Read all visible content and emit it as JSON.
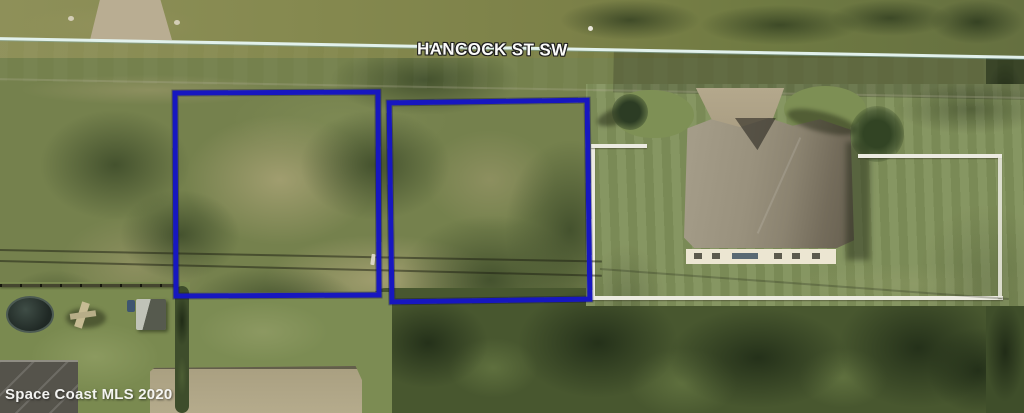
{
  "labels": {
    "street_name": "HANCOCK ST SW",
    "watermark": "Space Coast MLS 2020"
  },
  "colors": {
    "parcel_outline": "#1717c0",
    "road_edge_line": "#e2f1ec"
  },
  "parcels": [
    {
      "id": "west",
      "left": 173,
      "top": 90,
      "width": 208,
      "height": 208,
      "rotation_deg": -0.3
    },
    {
      "id": "east",
      "left": 388,
      "top": 99,
      "width": 203,
      "height": 204,
      "rotation_deg": -0.8
    }
  ]
}
